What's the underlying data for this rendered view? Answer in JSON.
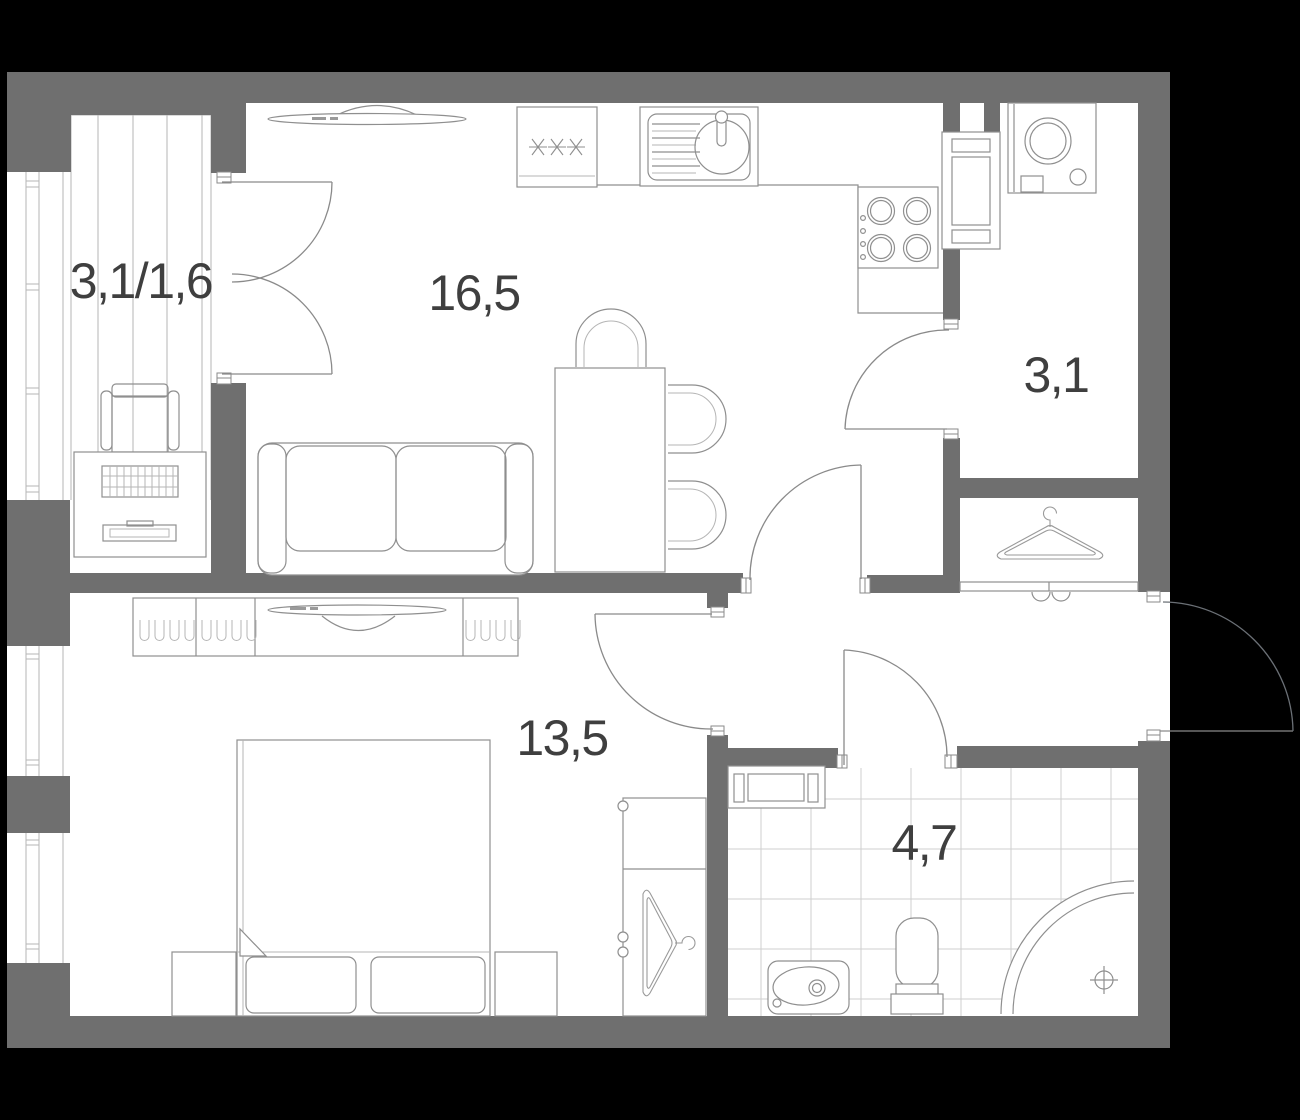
{
  "plan": {
    "type": "apartment-floor-plan",
    "rooms": [
      {
        "name": "balcony",
        "label": "3,1/1,6"
      },
      {
        "name": "living-kitchen",
        "label": "16,5"
      },
      {
        "name": "hallway",
        "label": "3,1"
      },
      {
        "name": "bedroom",
        "label": "13,5"
      },
      {
        "name": "bathroom",
        "label": "4,7"
      }
    ],
    "fixtures": [
      "fridge",
      "kitchen-sink",
      "stove",
      "vent-shaft",
      "washing-machine",
      "tv",
      "sofa",
      "dining-table",
      "dining-chairs",
      "coat-hanger",
      "sliding-closet",
      "wardrobe",
      "bed",
      "pillows",
      "nightstands",
      "dresser",
      "desk",
      "desk-chair",
      "radiator",
      "washbasin",
      "toilet",
      "corner-shower",
      "windows",
      "deck-planks"
    ],
    "colors": {
      "wall": "#6f6f6f",
      "outline": "#8f8f8f",
      "light_outline": "#b5b5b5",
      "tile": "#cfcfcf",
      "label": "#3f3f3f",
      "floor": "#ffffff",
      "outside": "#000000"
    }
  }
}
